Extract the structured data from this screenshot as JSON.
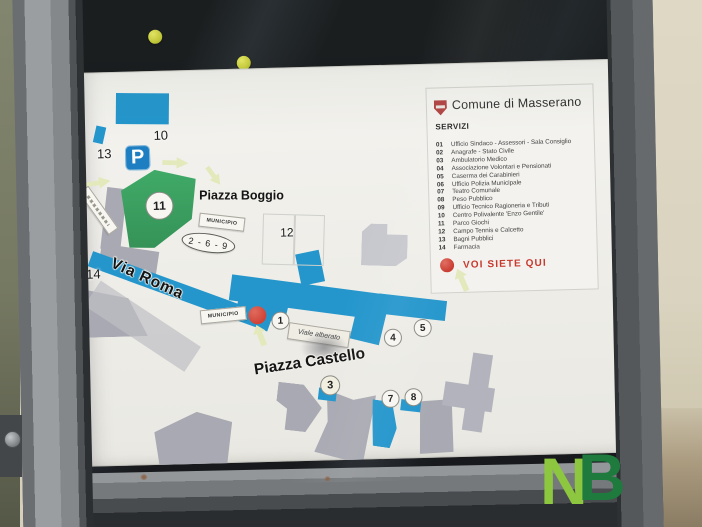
{
  "board": {
    "legend": {
      "crest_icon": "masserano-coat-of-arms",
      "title": "Comune di Masserano",
      "section_title": "SERVIZI",
      "items": [
        {
          "num": "01",
          "label": "Ufficio Sindaco - Assessori - Sala Consiglio"
        },
        {
          "num": "02",
          "label": "Anagrafe - Stato Civile"
        },
        {
          "num": "03",
          "label": "Ambulatorio Medico"
        },
        {
          "num": "04",
          "label": "Associazione Volontari e Pensionati"
        },
        {
          "num": "05",
          "label": "Caserma dei Carabinieri"
        },
        {
          "num": "06",
          "label": "Ufficio Polizia Municipale"
        },
        {
          "num": "07",
          "label": "Teatro Comunale"
        },
        {
          "num": "08",
          "label": "Peso Pubblico"
        },
        {
          "num": "09",
          "label": "Ufficio Tecnico Ragioneria e Tributi"
        },
        {
          "num": "10",
          "label": "Centro Polivalente 'Enzo Gentile'"
        },
        {
          "num": "11",
          "label": "Parco Giochi"
        },
        {
          "num": "12",
          "label": "Campo Tennis e Calcetto"
        },
        {
          "num": "13",
          "label": "Bagni Pubblici"
        },
        {
          "num": "14",
          "label": "Farmacia"
        }
      ],
      "you_are_here": "VOI SIETE QUI"
    },
    "map": {
      "streets": {
        "via_roma": "Via Roma",
        "viale_alberato": "Viale alberato"
      },
      "places": {
        "piazza_boggio": "Piazza Boggio",
        "piazza_castello": "Piazza Castello"
      },
      "ribbons": {
        "municipio": "MUNICIPIO"
      },
      "parking_symbol": "P",
      "group_marker": "2 - 6 - 9",
      "markers": {
        "m1": "1",
        "m3": "3",
        "m4": "4",
        "m5": "5",
        "m7": "7",
        "m8": "8",
        "m10": "10",
        "m11": "11",
        "m12": "12",
        "m13": "13",
        "m14": "14"
      }
    }
  },
  "watermark": {
    "n": "N",
    "b": "B"
  },
  "colors": {
    "map_blue": "#2496cc",
    "map_green": "#3ba162",
    "building_gray": "#a8a9b2",
    "light_building_gray": "#c7c8ce",
    "marker_red": "#cf4437",
    "legend_red": "#c8382d",
    "arrow_green": "#e3e9bb",
    "frame_gray": "#75797c",
    "backing_black": "#17191c",
    "wall_cream": "#dbd5c1",
    "magnet_yellow": "#d6d845",
    "nb_light_green": "#8dc63f",
    "nb_dark_green": "#1e7a3d"
  }
}
